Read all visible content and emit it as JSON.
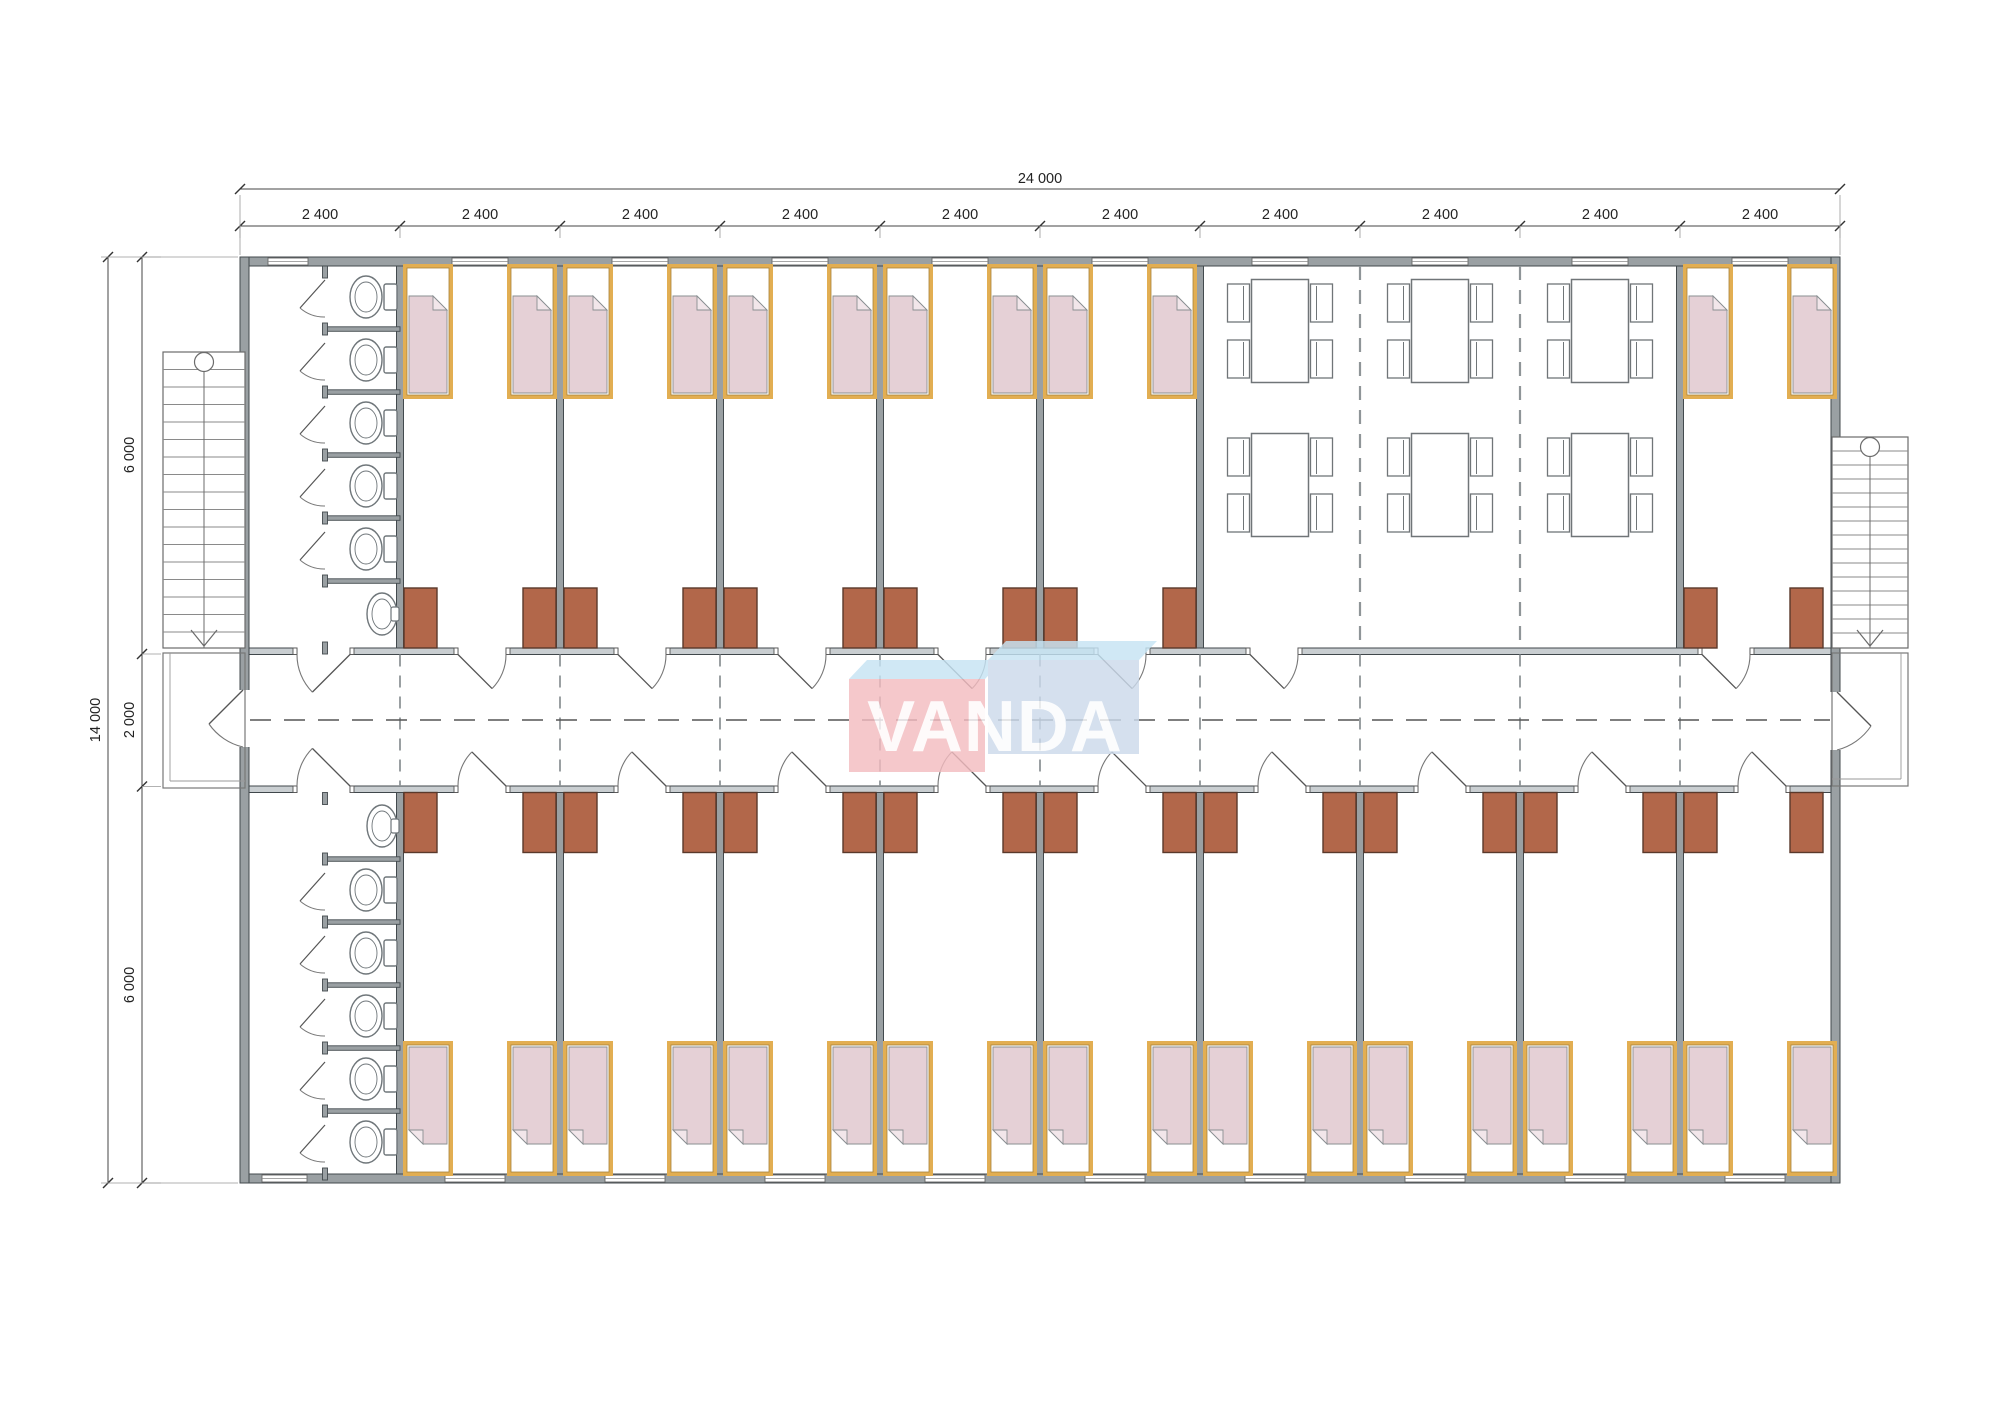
{
  "page": {
    "background": "#ffffff",
    "kind": "architectural floor plan"
  },
  "watermark": {
    "text": "VANDA"
  },
  "dimensions": {
    "top": {
      "total": "24 000",
      "segments": [
        "2 400",
        "2 400",
        "2 400",
        "2 400",
        "2 400",
        "2 400",
        "2 400",
        "2 400",
        "2 400",
        "2 400"
      ]
    },
    "left": {
      "total": "14 000",
      "segments": [
        "6 000",
        "2 000",
        "6 000"
      ]
    }
  },
  "plan": {
    "modules": 10,
    "corridor": "central, with dashed centerline",
    "rooms": {
      "bathrooms": [
        {
          "position": "top-left",
          "wc_stalls": 5,
          "toilets": 5,
          "sinks": 1
        },
        {
          "position": "bottom-left",
          "wc_stalls": 5,
          "toilets": 5,
          "sinks": 1
        }
      ],
      "bedrooms_top": 6,
      "bedrooms_bottom": 9,
      "beds_per_bedroom": 2,
      "dining": {
        "tables": 6,
        "chairs_per_table": 4,
        "modules_spanned": 3
      },
      "stairs": [
        "left",
        "right"
      ],
      "entrances": 2
    },
    "colors": {
      "wall": "#9aa0a3",
      "wall_edge": "#434a4e",
      "corridor_wall": "#c9ced1",
      "line": "#5a5f62",
      "thin": "#8a8f92",
      "bed_border": "#e2ae52",
      "bed_border_edge": "#a8833b",
      "bed_blanket": "#e5d0d6",
      "bed_fold": "#f2e6ea",
      "wardrobe": "#b2674a",
      "wardrobe_edge": "#5a392b",
      "fixture": "#6f767a",
      "furniture": "#707578",
      "dim_line": "#444444",
      "dim_text": "#222222",
      "logo_pink": "#f3bcc0",
      "logo_blue_face": "#ccdaeb",
      "logo_blue_top": "#c6e4f4",
      "logo_text": "#ffffff"
    }
  }
}
